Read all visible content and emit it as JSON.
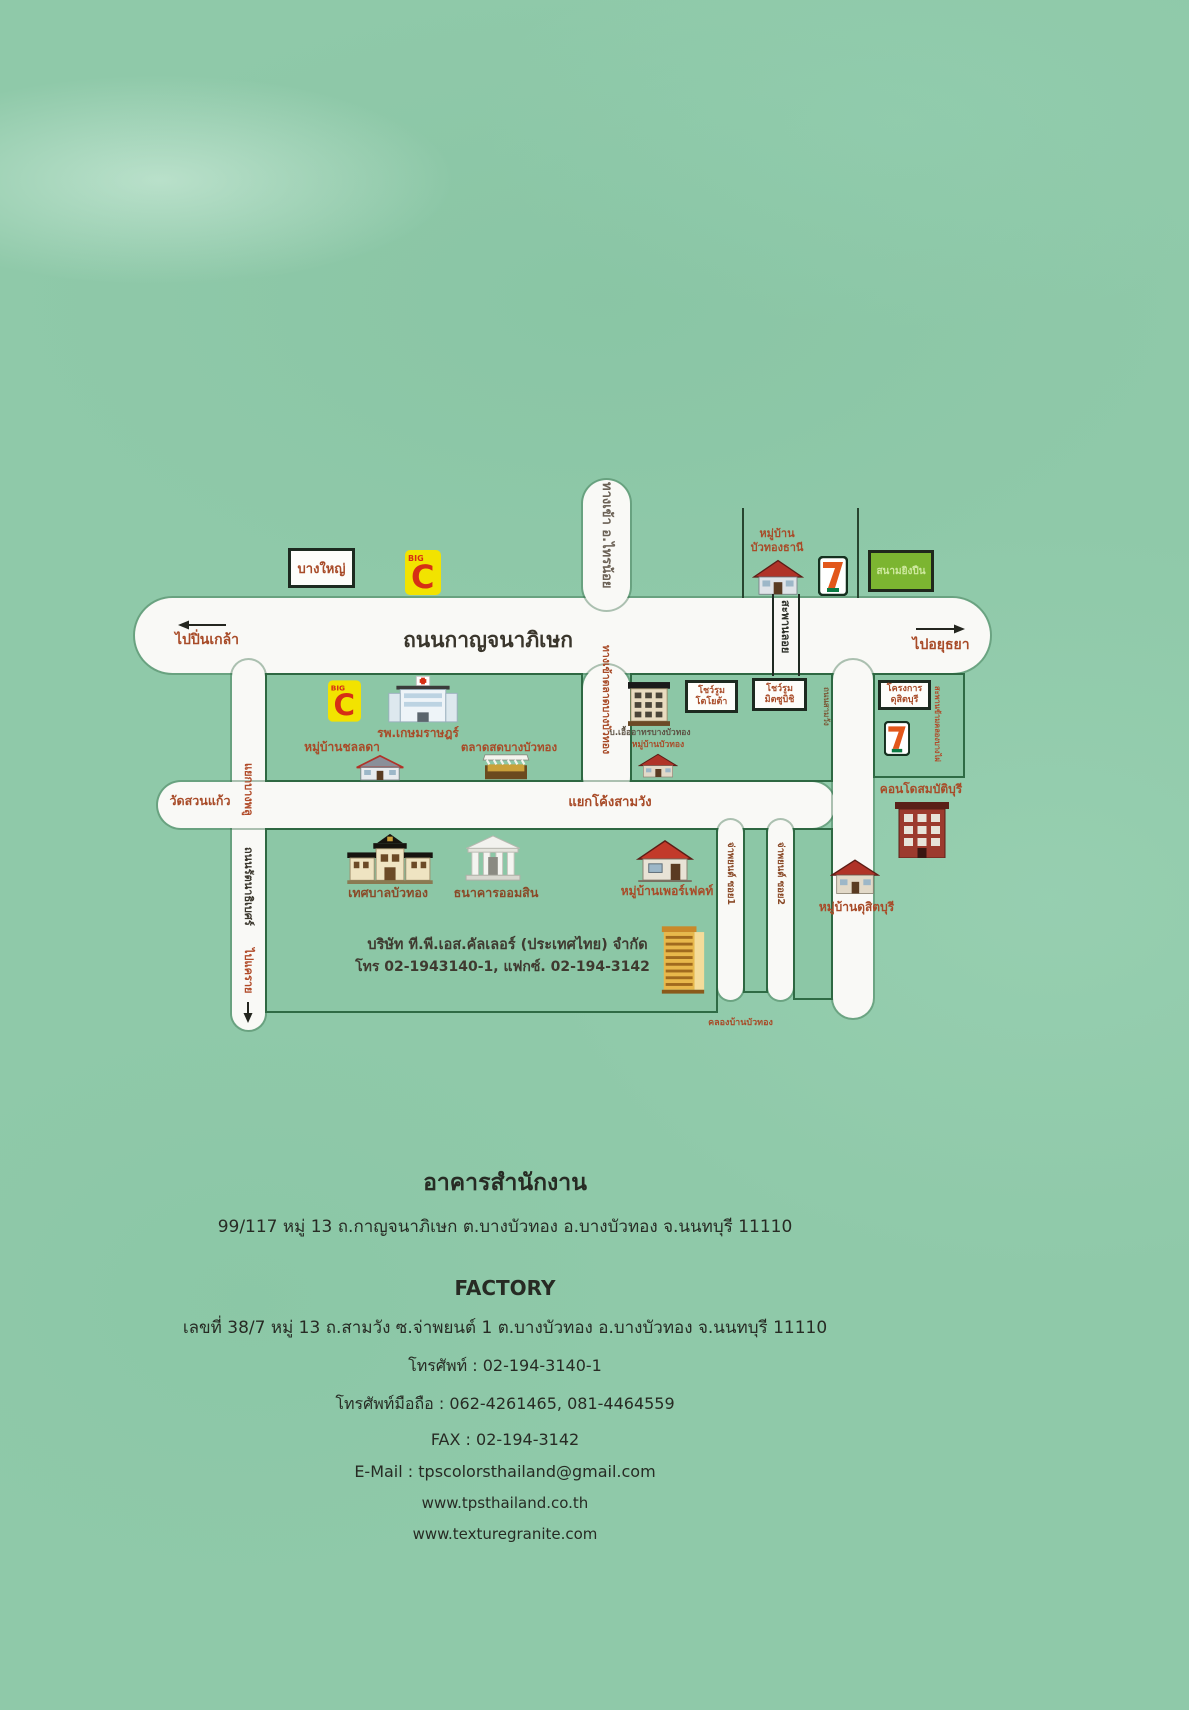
{
  "colors": {
    "background_green": "#8fc9a9",
    "road_white": "#f9f9f6",
    "block_border_green": "#2f6b45",
    "label_red_brown": "#a84b28",
    "label_dark": "#3a362c",
    "bigc_yellow": "#f2e300",
    "bigc_red": "#d62f15",
    "seven_orange": "#e2571b",
    "seven_green": "#0b7b44",
    "shooting_range_green": "#7cb531"
  },
  "map": {
    "road_labels": {
      "kanchanaphisek": "ถนนกาญจนาภิเษก",
      "to_pinklao": "ไปปิ่นเกล้า",
      "to_ayutthaya": "ไปอยุธยา",
      "sainoi": "ทางเข้า อ.ไทรน้อย",
      "market_entrance": "ทางเข้าตลาดบางบัวทอง",
      "overpass": "สะพานลอย",
      "samwang_junction": "แยกโค้งสามวัง",
      "samwang_road": "ถนนสามวัง",
      "bangphlu_junction": "แยกบางพลู",
      "rattanathibet": "ถนนรัตนาธิเบศร์",
      "to_khaerai": "ไปแคราย",
      "soi1": "จ่าพยนต์ ซอย1",
      "soi2": "จ่าพยนต์ ซอย2",
      "canal": "คลองบ้านบัวทอง",
      "canal_bridge": "สะพานข้ามคลองบางไผ่"
    },
    "places": {
      "bangyai": "บางใหญ่",
      "shooting_range": "สนามยิงปืน",
      "buathong_thani_1": "หมู่บ้าน",
      "buathong_thani_2": "บัวทองธานี",
      "hospital": "รพ.เกษมราษฎร์",
      "chonlada": "หมู่บ้านชลลดา",
      "market": "ตลาดสดบางบัวทอง",
      "uea_athon": "บ.เอื้ออาทรบางบัวทอง",
      "buathong_village": "หมู่บ้านบัวทอง",
      "showroom1_1": "โชว์รูม",
      "showroom1_2": "โตโยต้า",
      "showroom2_1": "โชว์รูม",
      "showroom2_2": "มิตซูบิชิ",
      "dusitburi_1": "โครงการ",
      "dusitburi_2": "ดุสิตบุรี",
      "condo": "คอนโดสมบัติบุรี",
      "dusitburi_village": "หมู่บ้านดุสิตบุรี",
      "watsuankaew": "วัดสวนแก้ว",
      "municipality": "เทศบาลบัวทอง",
      "bank": "ธนาคารออมสิน",
      "perfect": "หมู่บ้านเพอร์เฟคท์"
    },
    "logos": {
      "bigc_small": "BIG",
      "bigc": "C",
      "seven": "7"
    },
    "company": {
      "name": "บริษัท ที.พี.เอส.คัลเลอร์ (ประเทศไทย) จำกัด",
      "phone_line": "โทร 02-1943140-1, แฟกซ์. 02-194-3142"
    }
  },
  "footer": {
    "office_heading": "อาคารสำนักงาน",
    "office_address": "99/117 หมู่ 13 ถ.กาญจนาภิเษก ต.บางบัวทอง อ.บางบัวทอง จ.นนทบุรี 11110",
    "factory_heading": "FACTORY",
    "factory_address": "เลขที่ 38/7 หมู่ 13 ถ.สามวัง ซ.จ่าพยนต์ 1 ต.บางบัวทอง อ.บางบัวทอง จ.นนทบุรี 11110",
    "phone": "โทรศัพท์ : 02-194-3140-1",
    "mobile": "โทรศัพท์มือถือ : 062-4261465, 081-4464559",
    "fax": "FAX : 02-194-3142",
    "email": "E-Mail : tpscolorsthailand@gmail.com",
    "website1": "www.tpsthailand.co.th",
    "website2": "www.texturegranite.com"
  }
}
